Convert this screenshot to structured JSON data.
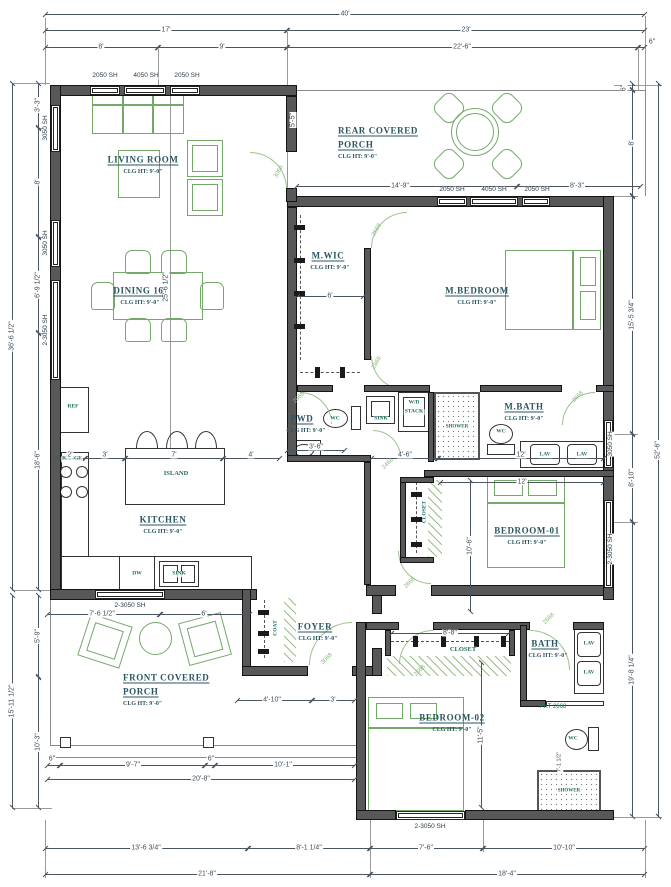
{
  "meta": {
    "clg": "CLG HT: 9'-0\""
  },
  "rooms": {
    "living": "LIVING ROOM",
    "dining": "DINING 16'",
    "rear_porch_1": "REAR COVERED",
    "rear_porch_2": "PORCH",
    "mwic": "M.WIC",
    "mbedroom": "M.BEDROOM",
    "pwd": "PWD",
    "mbath": "M.BATH",
    "kitchen": "KITCHEN",
    "bedroom1": "BEDROOM-01",
    "foyer": "FOYER",
    "bath": "BATH",
    "front_porch_1": "FRONT COVERED",
    "front_porch_2": "PORCH",
    "bedroom2": "BEDROOM-02"
  },
  "fixtures": {
    "ref": "REF",
    "range": "RANGE",
    "island": "ISLAND",
    "dw": "DW",
    "sink": "SINK",
    "wd1": "W/D",
    "wd2": "STACK",
    "shower": "SHOWER",
    "wc": "WC",
    "lav": "LAV",
    "coat": "COAT",
    "closet": "CLOSET"
  },
  "windows": {
    "w2050": "2050 SH",
    "w4050": "4050 SH",
    "w3050": "3050 SH",
    "w23050": "2-3050 SH"
  },
  "doors": {
    "d3068": "3068",
    "d2668": "2668",
    "d2868": "2868",
    "d2468": "2468",
    "pkt2668": "PKT 2668"
  },
  "dims": {
    "ft40": "40'",
    "ft17": "17'",
    "ft23": "23'",
    "ft8": "8'",
    "ft9": "9'",
    "ft22_6": "22'-6\"",
    "in6": "6\"",
    "ft13_6_3_4": "13'-6 3/4\"",
    "ft8_1_1_4": "8'-1 1/4\"",
    "ft7_6": "7'-6\"",
    "ft10_10": "10'-10\"",
    "ft21_8": "21'-8\"",
    "ft18_4": "18'-4\"",
    "ft3_3": "3'-3\"",
    "ft6_9_1_2": "6'-9 1/2\"",
    "ft18_6": "18'-6\"",
    "ft36_6_1_2": "36'-6 1/2\"",
    "ft5_9": "5'-9\"",
    "ft10_3": "10'-3\"",
    "ft15_11_1_2": "15'-11 1/2\"",
    "ft15_5_3_4": "15'-5 3/4\"",
    "ft8_10": "8'-10\"",
    "ft19_8_1_4": "19'-8 1/4\"",
    "ft52_6": "52'-6\"",
    "ft14_9": "14'-9\"",
    "ft8_3": "8'-3\"",
    "ft5_5": "5'-5\"",
    "ft6": "6'",
    "ft2": "2'",
    "ft3": "3'",
    "ft7": "7'",
    "ft4": "4'",
    "ft3_6": "3'-6\"",
    "ft4_6": "4'-6\"",
    "ft12": "12'",
    "ft10_6": "10'-6\"",
    "ft8_8": "8'-8\"",
    "ft25_6_1_2": "25'-6 1/2\"",
    "ft7_6_1_2": "7'-6 1/2\"",
    "ft4_10": "4'-10\"",
    "ft3b": "3'",
    "ft9_7": "9'-7\"",
    "ft10_1": "10'-1\"",
    "ft20_8": "20'-8\"",
    "ft11_5": "11'-5\"",
    "ft7_1_1_2": "7'-1 1/2\""
  }
}
